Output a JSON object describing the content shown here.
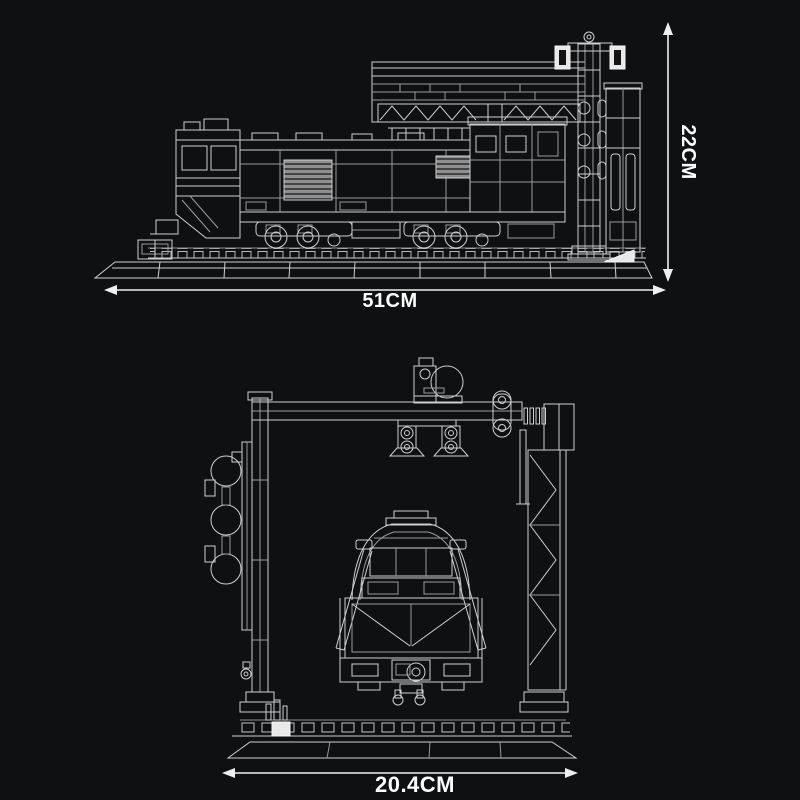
{
  "colors": {
    "background": "#0f1011",
    "line": "#cfcfcf",
    "bright_line": "#f2f2f2",
    "fill_white": "#e9e9e9",
    "text": "#ffffff"
  },
  "diagram": {
    "type": "product-dimension-diagram",
    "subject": "Brick-built diesel locomotive with signal gantry shown as wireframe line art, side elevation above and front elevation below",
    "side_view": {
      "width_label": "51CM",
      "height_label": "22CM"
    },
    "front_view": {
      "width_label": "20.4CM"
    }
  }
}
